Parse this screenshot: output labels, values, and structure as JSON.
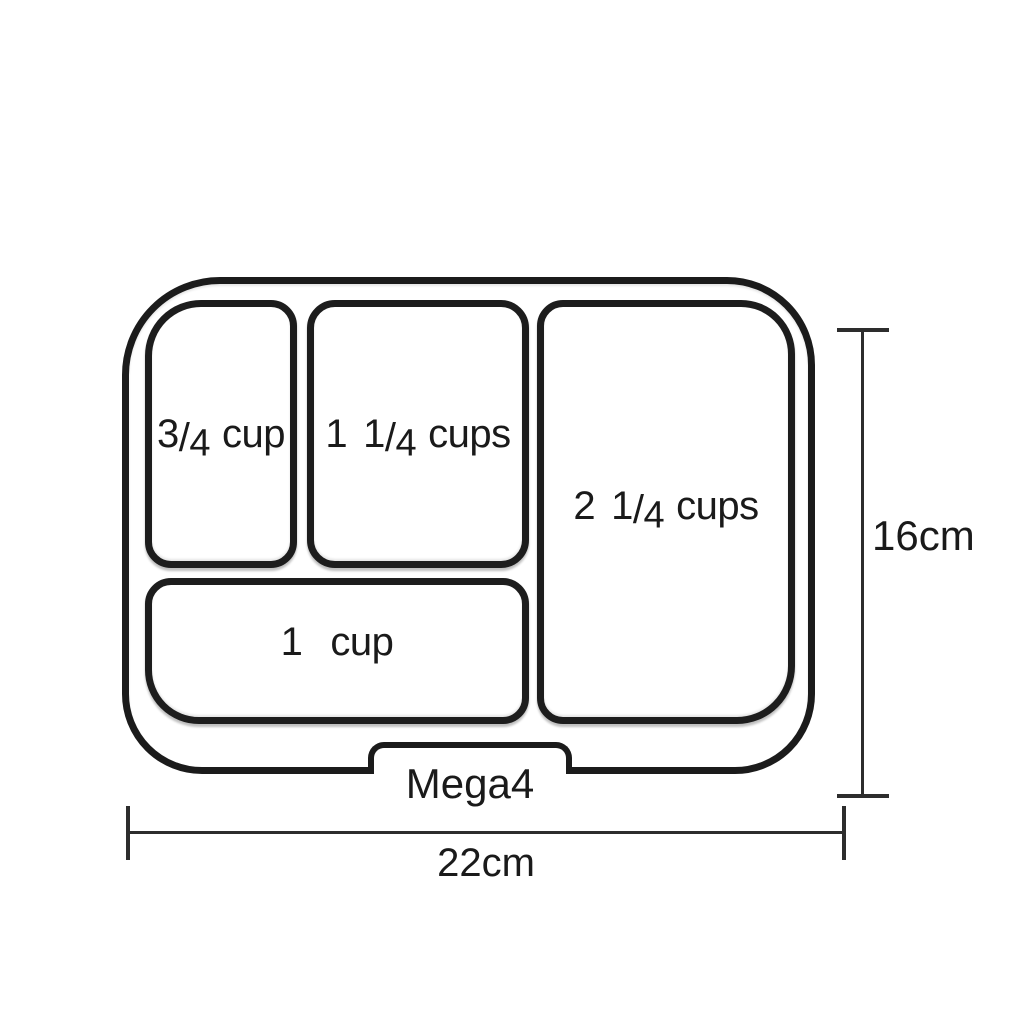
{
  "tray": {
    "model_label": "Mega4",
    "compartments": [
      {
        "position": "top-left",
        "whole": "",
        "numerator": "3",
        "slash": "/",
        "denominator": "4",
        "unit": "cup"
      },
      {
        "position": "top-middle",
        "whole": "1",
        "numerator": "1",
        "slash": "/",
        "denominator": "4",
        "unit": "cups"
      },
      {
        "position": "right",
        "whole": "2",
        "numerator": "1",
        "slash": "/",
        "denominator": "4",
        "unit": "cups"
      },
      {
        "position": "bottom",
        "whole": "1",
        "numerator": "",
        "slash": "",
        "denominator": "",
        "unit": "cup"
      }
    ]
  },
  "dimensions": {
    "height_label": "16cm",
    "width_label": "22cm"
  },
  "colors": {
    "outline": "#1b1b1b",
    "dimension_line": "#2d2d2d",
    "text": "#1a1a1a",
    "background": "#ffffff"
  }
}
